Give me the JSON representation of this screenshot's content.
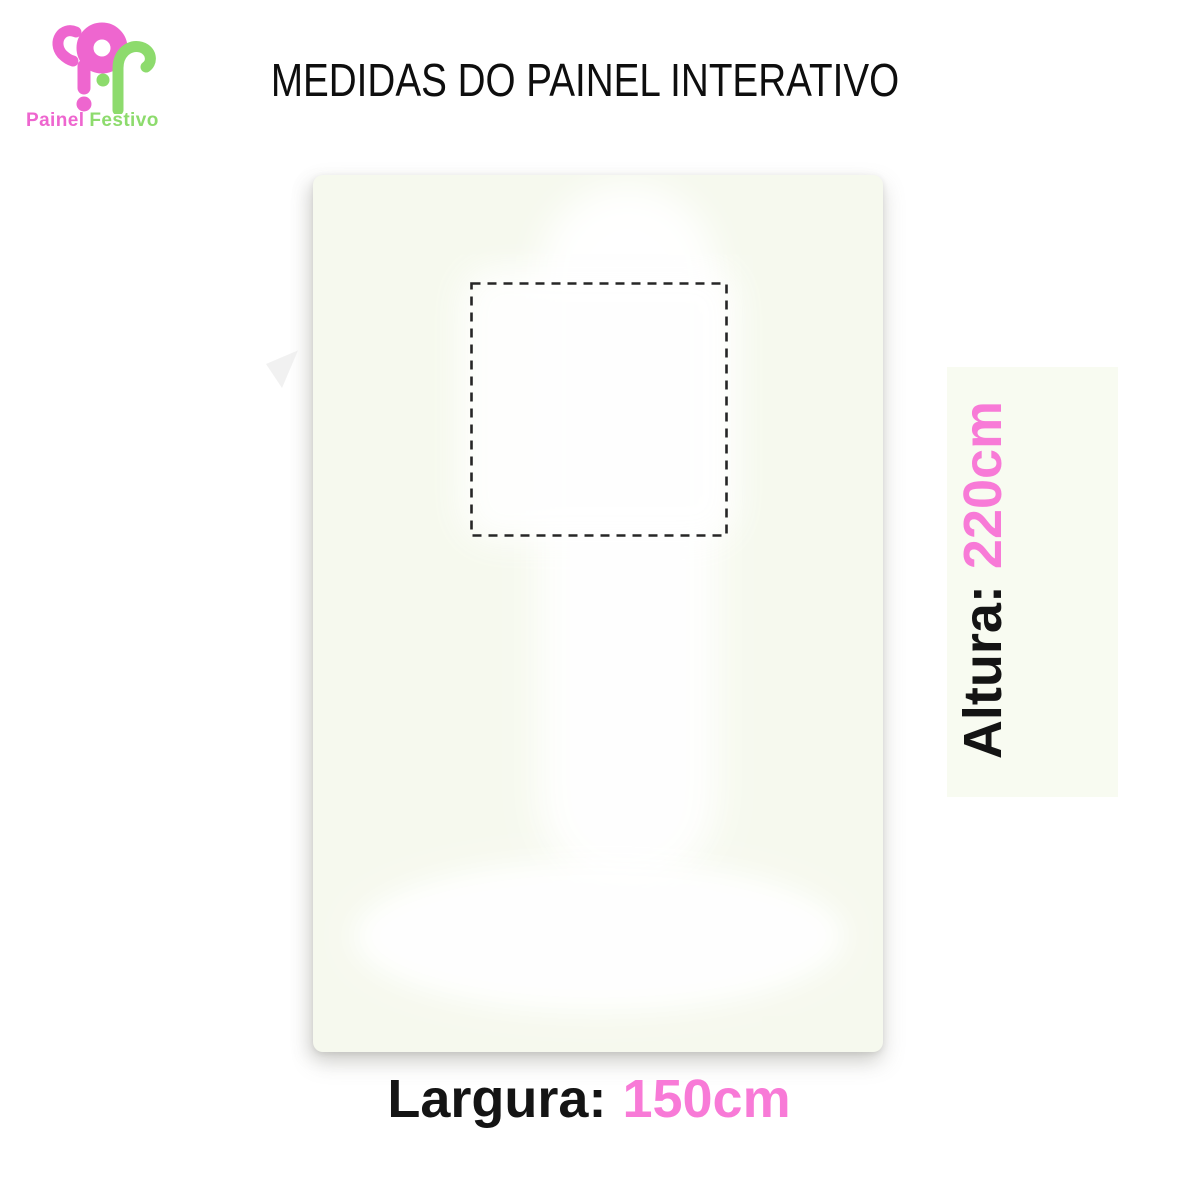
{
  "brand": {
    "name_primary": "Painel",
    "name_secondary": "Festivo",
    "logo_icon": "painel-festivo-pf-monogram"
  },
  "title": "MEDIDAS DO PAINEL INTERATIVO",
  "dimensions": {
    "height": {
      "label": "Altura:",
      "value": "220cm"
    },
    "width": {
      "label": "Largura:",
      "value": "150cm"
    }
  },
  "panel": {
    "cutout_marker": "dashed-square-placement-area"
  },
  "colors": {
    "accent_pink": "#f87ad7",
    "logo_pink": "#ee66cf",
    "logo_green": "#8ddb6d",
    "text_black": "#141414",
    "panel_background": "#f6f9ee",
    "page_background": "#ffffff"
  }
}
